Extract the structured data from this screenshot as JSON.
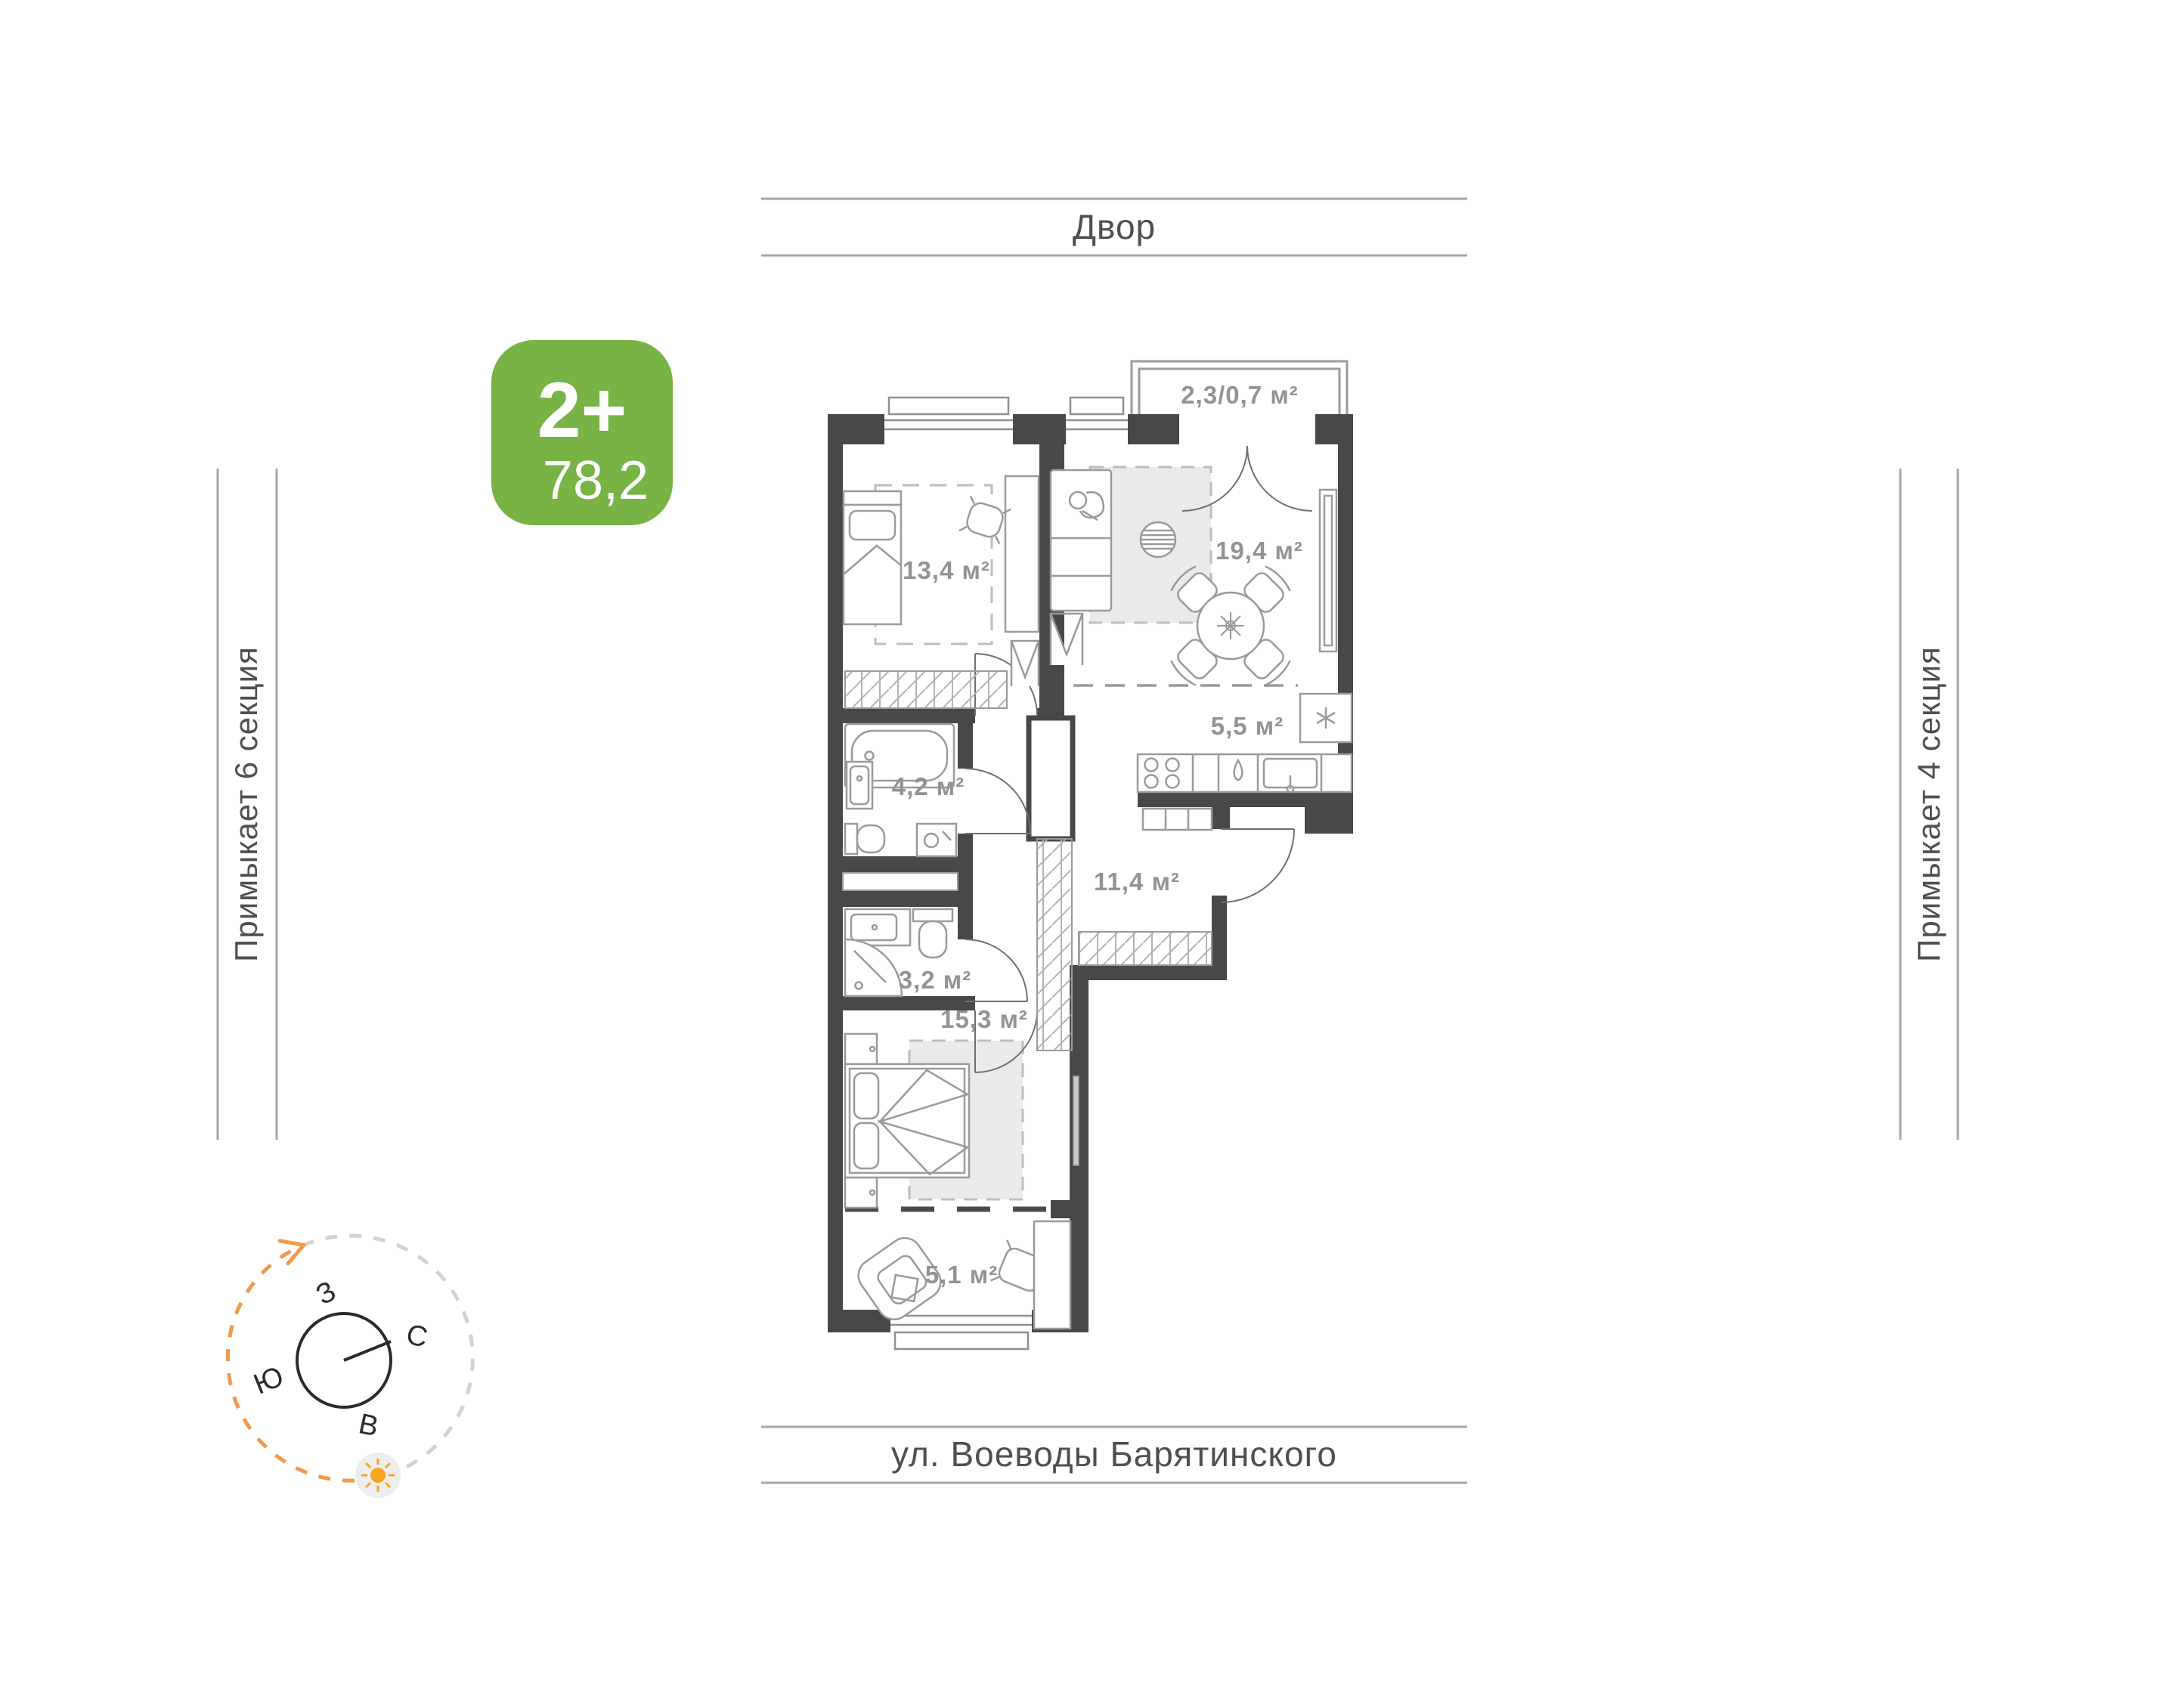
{
  "colors": {
    "wall": "#48484a",
    "furniture": "#9a9a9a",
    "label": "#939393",
    "accent_green": "#77b345",
    "accent_orange": "#f2994a",
    "sun": "#f5a623"
  },
  "badge": {
    "rooms": "2+",
    "area": "78,2"
  },
  "surroundings": {
    "top": "Двор",
    "bottom": "ул. Воеводы Барятинского",
    "left": "Примыкает 6 секция",
    "right": "Примыкает 4 секция"
  },
  "compass": {
    "north": "С",
    "west": "З",
    "south": "Ю",
    "east": "В"
  },
  "rooms": {
    "balcony": {
      "label": "2,3/0,7 м²"
    },
    "bedroom1": {
      "label": "13,4 м²"
    },
    "living": {
      "label": "19,4 м²"
    },
    "kitchen": {
      "label": "5,5 м²"
    },
    "bathroom": {
      "label": "4,2 м²"
    },
    "hall": {
      "label": "11,4 м²"
    },
    "wc": {
      "label": "3,2 м²"
    },
    "bedroom2": {
      "label": "15,3 м²"
    },
    "loggia": {
      "label": "5,1 м²"
    }
  }
}
